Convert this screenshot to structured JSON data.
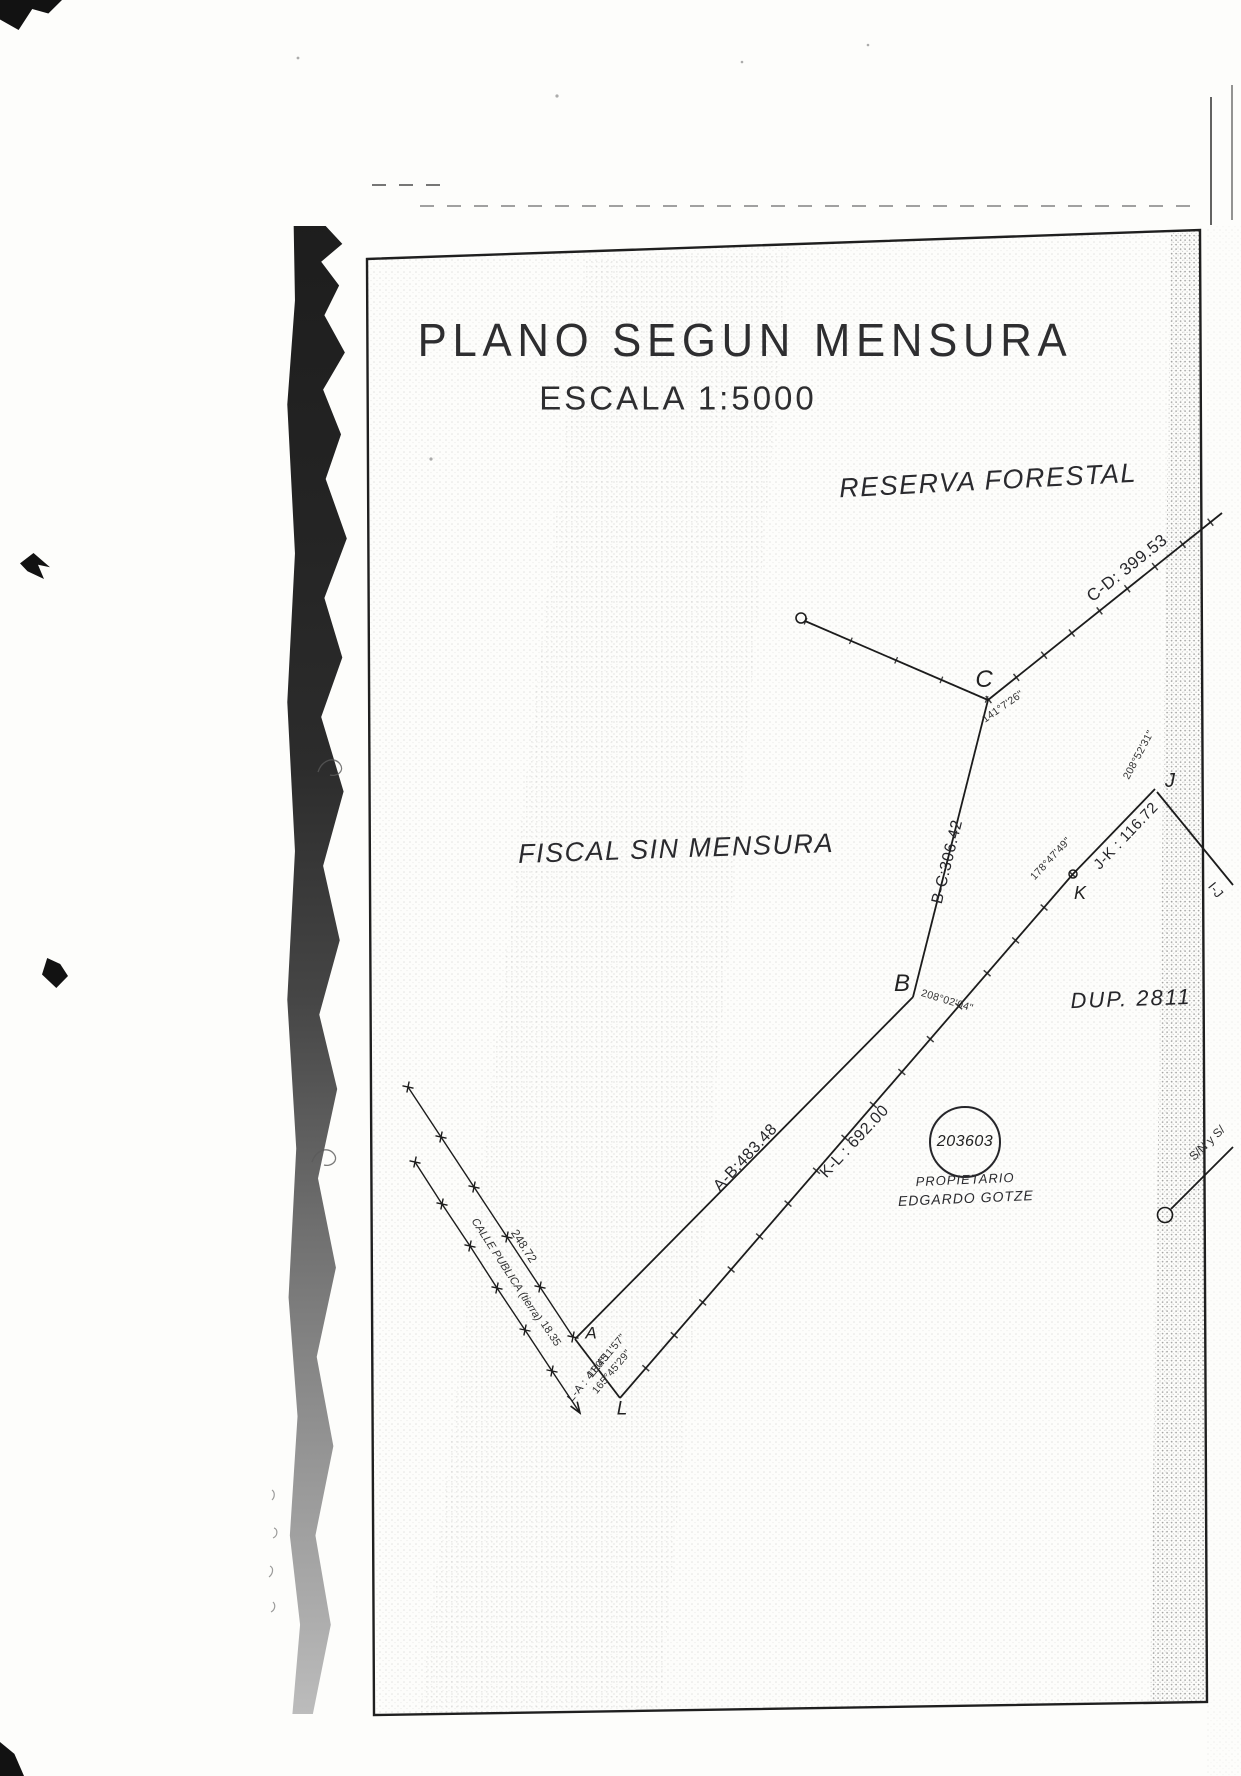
{
  "document": {
    "title": "PLANO SEGUN MENSURA",
    "scale": "ESCALA 1:5000"
  },
  "areas": {
    "reserva_forestal": "RESERVA FORESTAL",
    "fiscal_sin_mensura": "FISCAL SIN MENSURA",
    "dup": "DUP. 2811",
    "sin_label": "S/N y S/"
  },
  "parcel": {
    "number": "203603",
    "owner_label": "PROPIETARIO",
    "owner_name": "EDGARDO GOTZE"
  },
  "vertices": {
    "a": "A",
    "b": "B",
    "c": "C",
    "j": "J",
    "k": "K",
    "l": "L"
  },
  "edges": {
    "cd": "C-D: 399.53",
    "bc": "B-C:306.42",
    "ab": "A-B:483.48",
    "kl": "K-L : 692.00",
    "jk": "J-K : 116.72",
    "la": "L-A : 41.45",
    "ij": "I-J"
  },
  "angles": {
    "c": "141°7'26\"",
    "b": "208°02'04\"",
    "j": "208°52'31\"",
    "k": "178°47'49\"",
    "a": "180°11'57\"",
    "l": "165°45'29\""
  },
  "street": {
    "name": "CALLE PUBLICA (tierra)",
    "segment_1": "248.72",
    "segment_2": "18.35"
  },
  "colors": {
    "ink": "#1c1c1c",
    "paper": "#fdfdfb"
  }
}
